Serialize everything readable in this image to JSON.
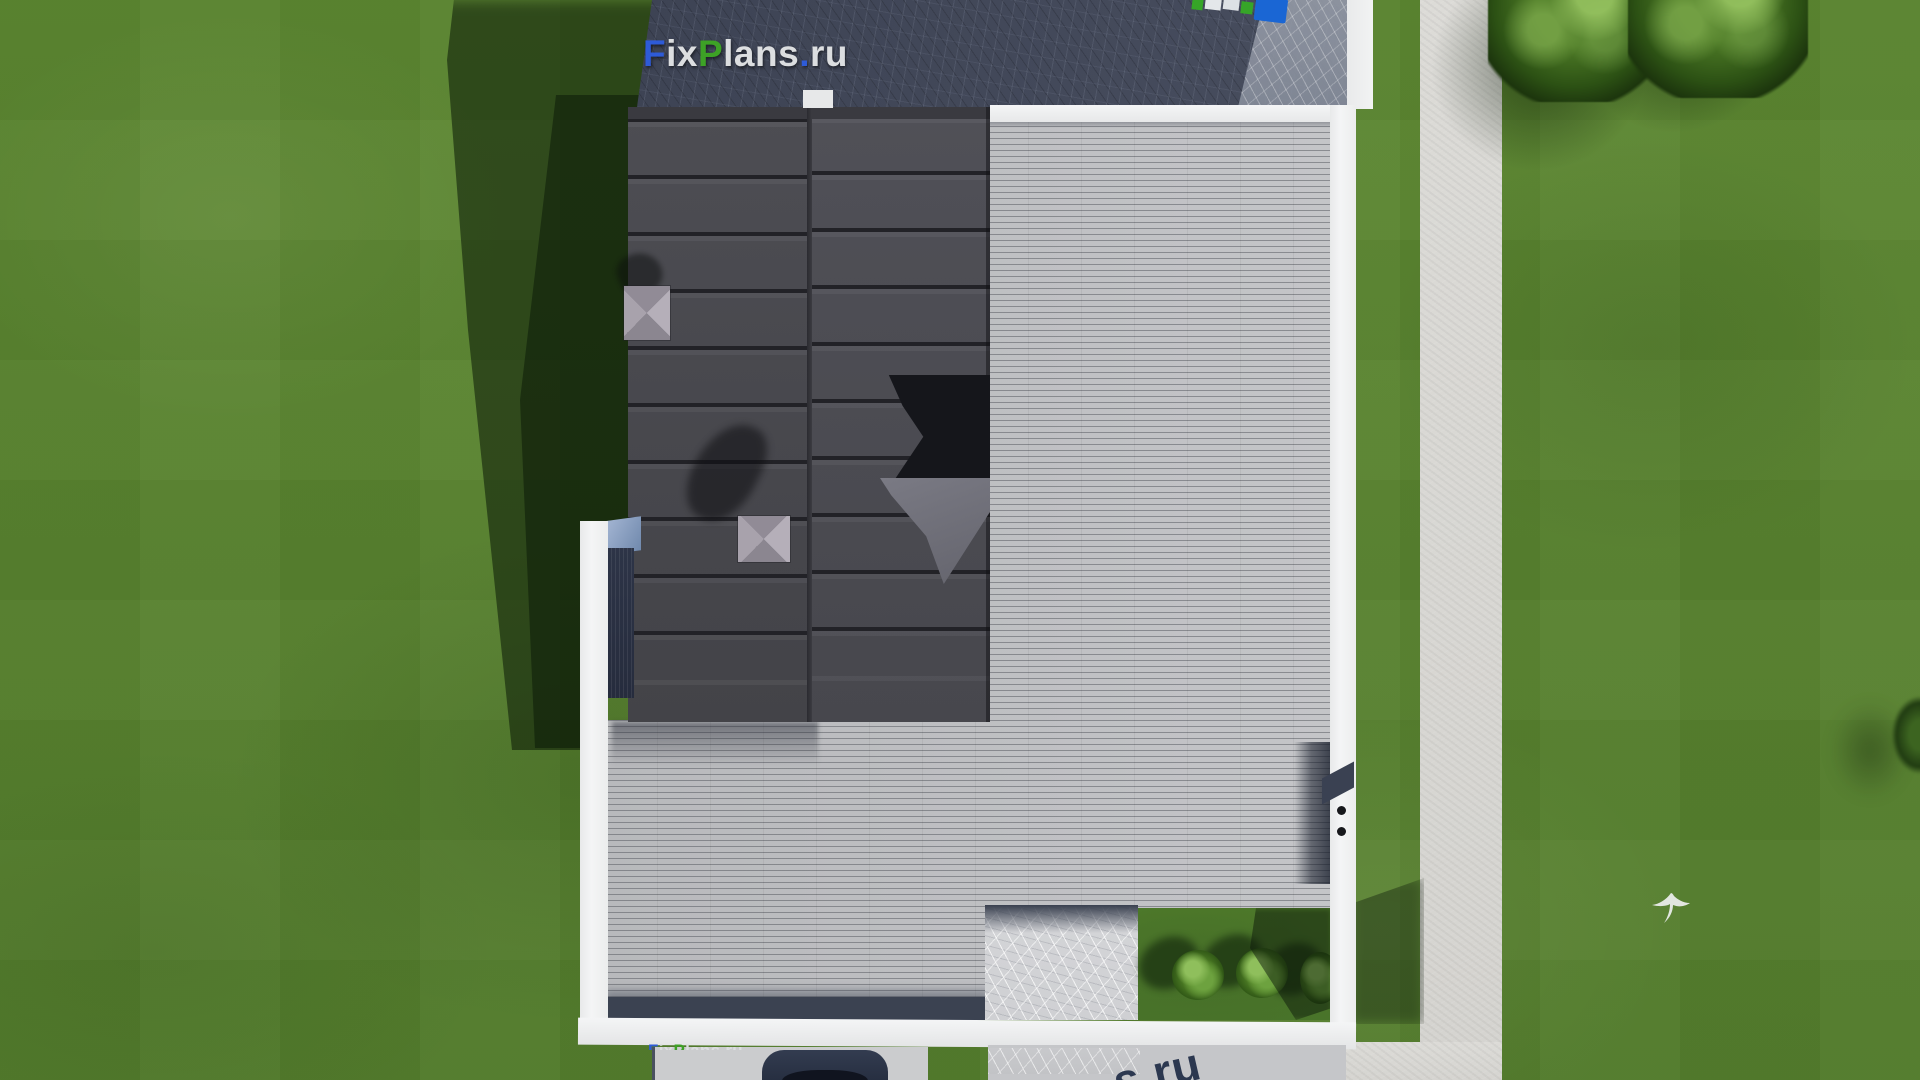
{
  "watermark": {
    "f": "F",
    "ix": "ix",
    "p": "P",
    "lans": "lans",
    "dot": ".",
    "ru": "ru",
    "full": "FixPlans.ru",
    "colors": {
      "blue": "#2e5bd7",
      "green": "#3da226",
      "light": "#dcdee0"
    }
  },
  "bottom_large_fragment": {
    "text": "s.ru",
    "color": "#2c3850"
  },
  "palette": {
    "grass": "#5a8530",
    "grass_shadow": "#1f3a12",
    "driveway_dark": "#414757",
    "roof_dark": "#4b4b51",
    "deck_gray": "#c0c1c4",
    "parapet_white": "#f1f2f3",
    "path_light": "#dbdad6",
    "stone_patio": "#d2d3d6",
    "courtyard_grass": "#4e7b2a",
    "car_navy": "#273043",
    "truck_blue": "#1a66d4",
    "truck_green": "#36a528",
    "chimney_gray": "#a8a2ac"
  }
}
